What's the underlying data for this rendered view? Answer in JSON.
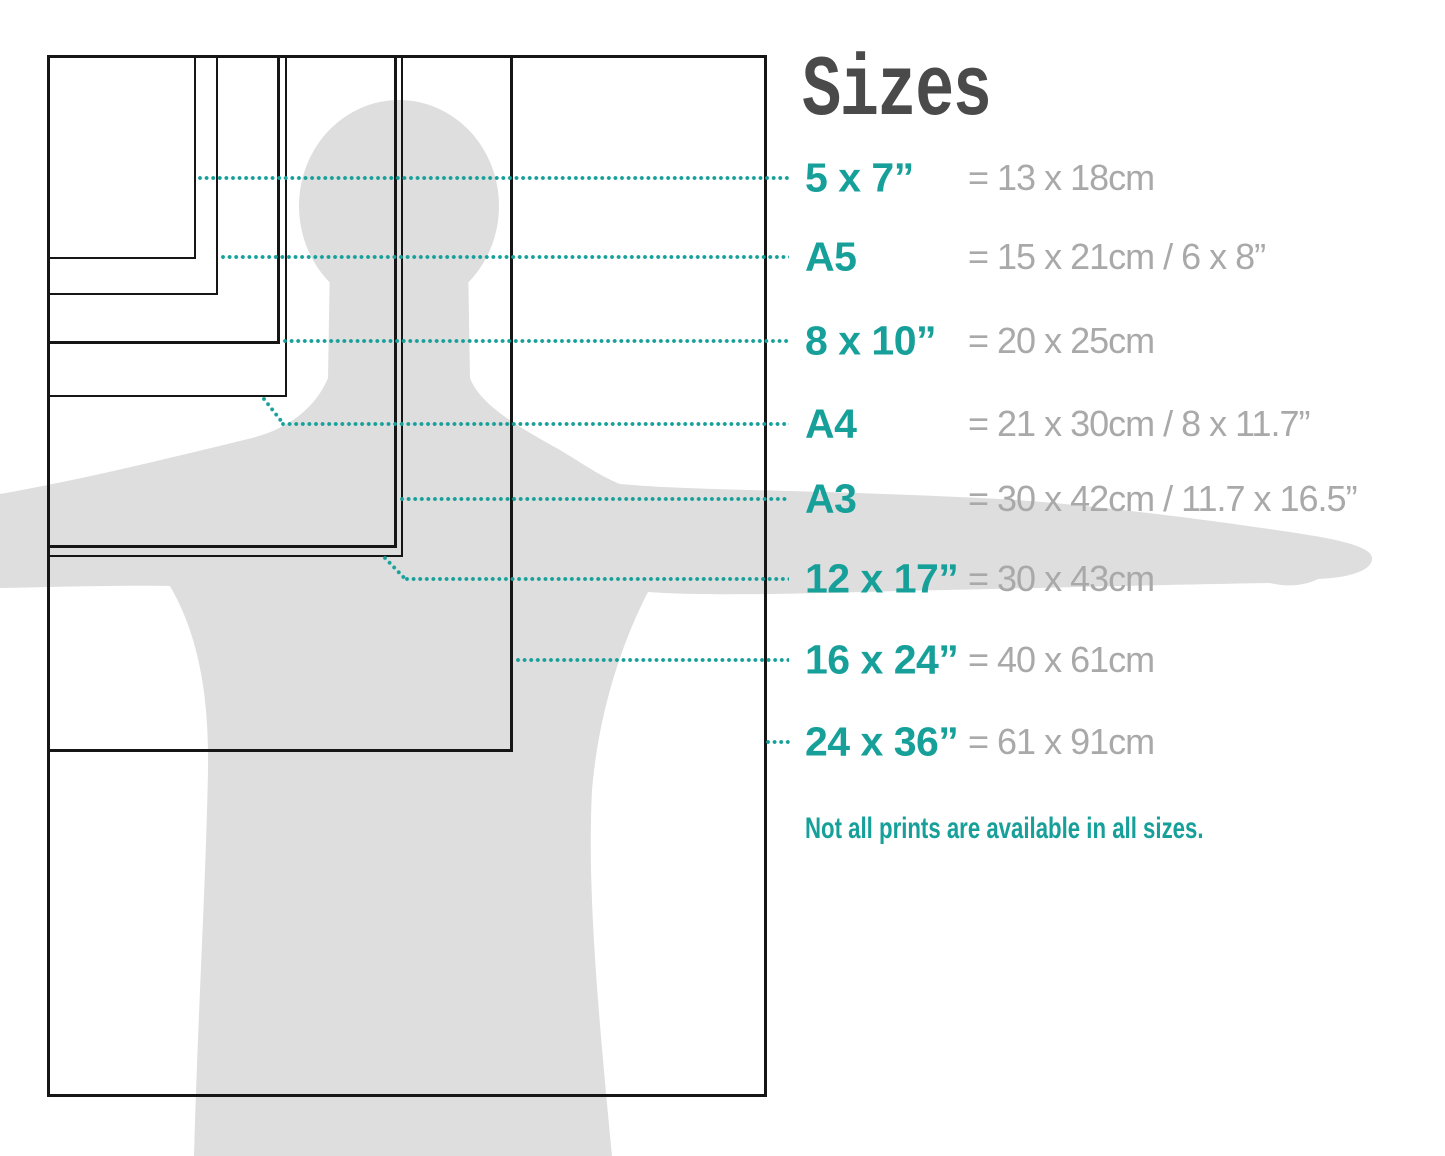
{
  "title": "Sizes",
  "note": "Not all prints are available in all sizes.",
  "colors": {
    "accent_teal": "#17a099",
    "value_gray": "#a9a9a9",
    "title_gray": "#4a4a4a",
    "silhouette_gray": "#dedede",
    "rect_outline": "#161616"
  },
  "sizes": [
    {
      "id": "5x7",
      "label": "5 x 7”",
      "metric": "= 13 x 18cm"
    },
    {
      "id": "a5",
      "label": "A5",
      "metric": "= 15 x 21cm / 6 x 8”"
    },
    {
      "id": "8x10",
      "label": "8 x 10”",
      "metric": "= 20 x 25cm"
    },
    {
      "id": "a4",
      "label": "A4",
      "metric": "= 21 x 30cm / 8 x 11.7”"
    },
    {
      "id": "a3",
      "label": "A3",
      "metric": "= 30 x 42cm / 11.7 x 16.5”"
    },
    {
      "id": "12x17",
      "label": "12 x 17”",
      "metric": "= 30 x 43cm"
    },
    {
      "id": "16x24",
      "label": "16 x 24”",
      "metric": "= 40 x 61cm"
    },
    {
      "id": "24x36",
      "label": "24 x 36”",
      "metric": "= 61 x 91cm"
    }
  ]
}
